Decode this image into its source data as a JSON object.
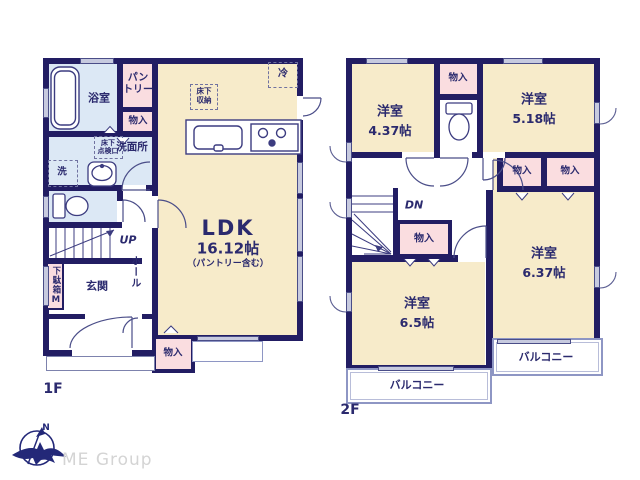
{
  "floor1": {
    "label": "1F",
    "bathroom": "浴室",
    "pantry": "パン\nトリー",
    "storage_upper": "物入",
    "washroom": "洗面所",
    "inspection_hatch": "床下\n点検口",
    "washer": "洗",
    "fridge": "冷",
    "underfloor_storage": "床下\n収納",
    "ldk": {
      "name": "LDK",
      "size": "16.12帖",
      "note": "（パントリー含む）"
    },
    "stairs_up": "UP",
    "hall": "ホール",
    "shoe_cabinet": "下駄箱M",
    "entrance": "玄関",
    "storage_lower": "物入"
  },
  "floor2": {
    "label": "2F",
    "room_nw": {
      "name": "洋室",
      "size": "4.37帖"
    },
    "storage_top": "物入",
    "room_ne": {
      "name": "洋室",
      "size": "5.18帖"
    },
    "stairs_dn": "DN",
    "storage_hall": "物入",
    "storage_mid_left": "物入",
    "storage_mid_right": "物入",
    "room_se": {
      "name": "洋室",
      "size": "6.37帖"
    },
    "room_sw": {
      "name": "洋室",
      "size": "6.5帖"
    },
    "balcony_left": "バルコニー",
    "balcony_right": "バルコニー"
  },
  "footer": {
    "company": "ME Group",
    "compass_north": "N"
  },
  "colors": {
    "wall": "#221d63",
    "text": "#2b2a6e",
    "room_cream": "#f7ebca",
    "closet_pink": "#fadde0",
    "wet_blue": "#dce8f5",
    "window_lavender": "#c7cadf",
    "balcony_line": "#8e96c4",
    "logo_gray": "#d4d4d4"
  }
}
